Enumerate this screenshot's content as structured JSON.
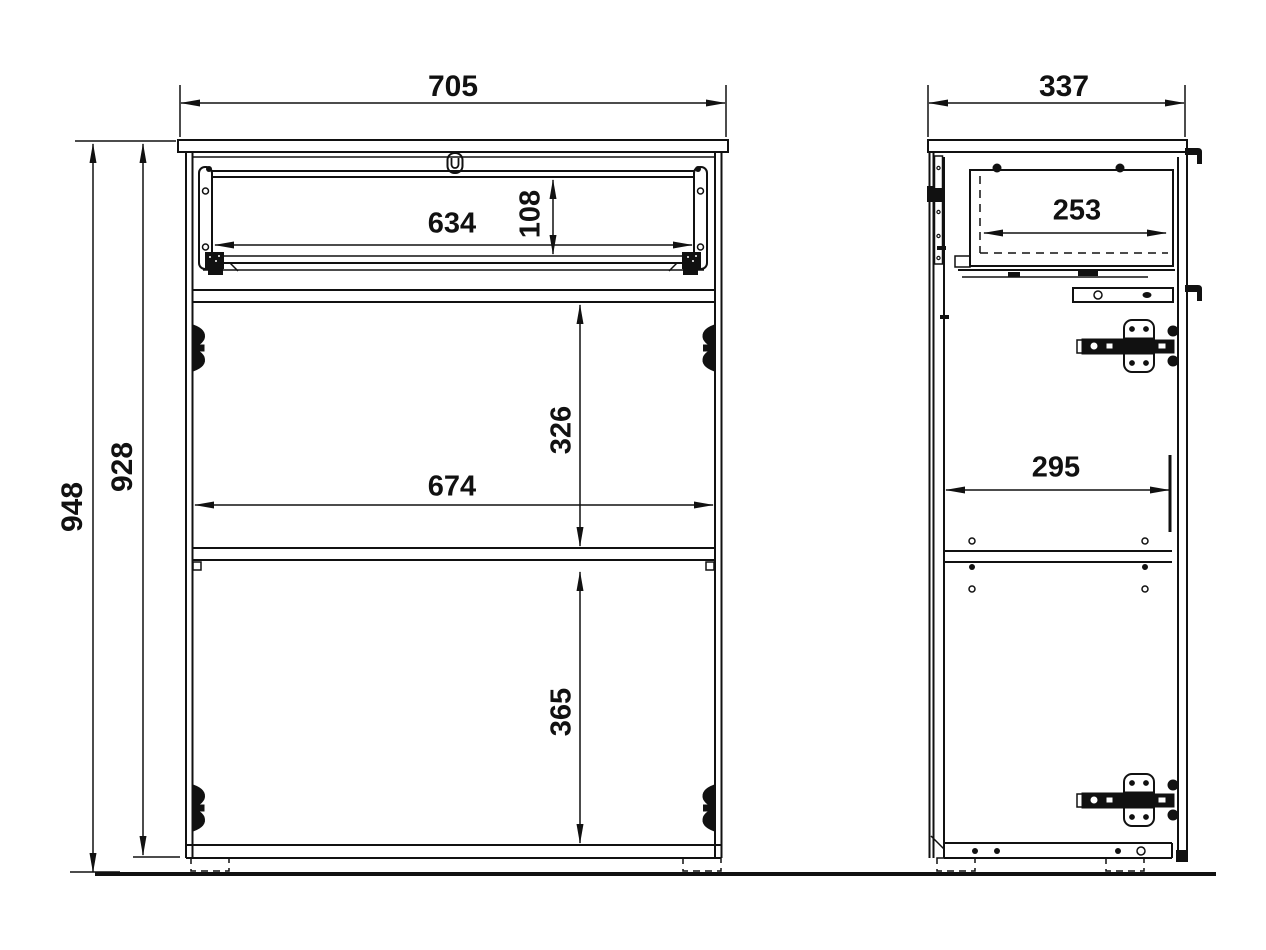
{
  "drawing": {
    "type": "furniture-technical-drawing",
    "views": [
      "front-view",
      "side-view"
    ],
    "line_color": "#111111",
    "background": "#ffffff"
  },
  "front_view": {
    "dims": {
      "width_705": "705",
      "height_948": "948",
      "height_928": "928",
      "drawer_width_634": "634",
      "drawer_height_108": "108",
      "compartment_326": "326",
      "inner_width_674": "674",
      "compartment_365": "365"
    }
  },
  "side_view": {
    "dims": {
      "depth_337": "337",
      "drawer_depth_253": "253",
      "inner_depth_295": "295"
    }
  },
  "icons": {
    "lock": "keyhole",
    "hinge": "cup-hinge",
    "wall_hook": "hanging-bracket"
  }
}
